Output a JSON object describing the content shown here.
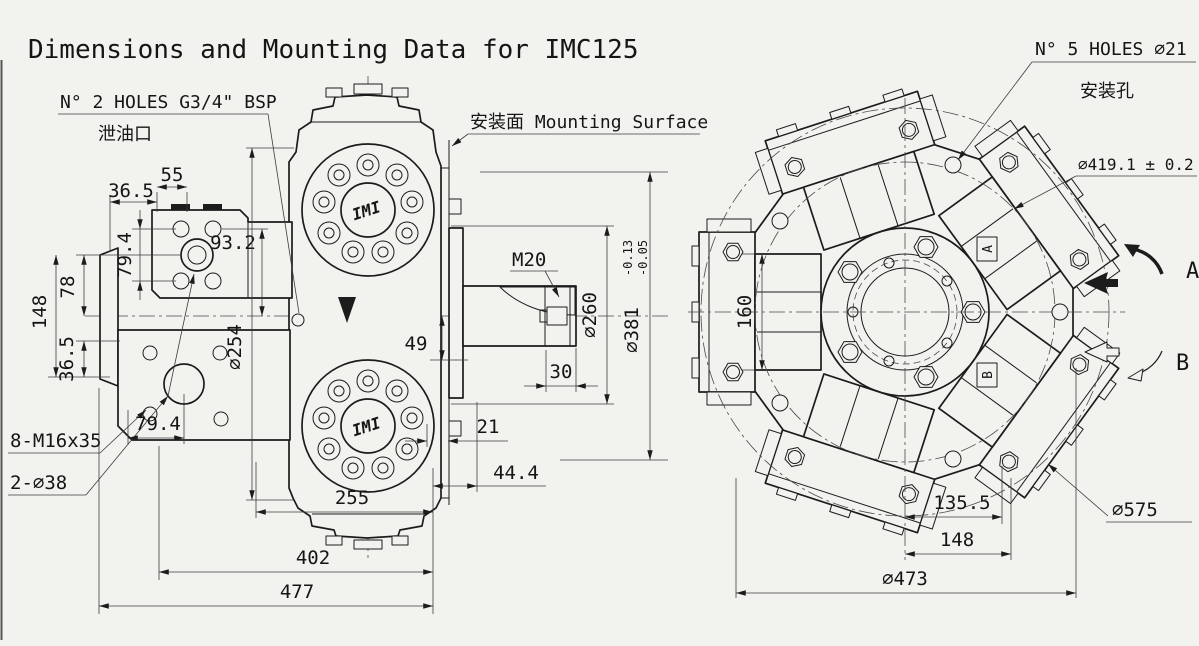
{
  "title": "Dimensions and Mounting Data for IMC125",
  "side_view": {
    "notes": {
      "holes_g34": "N° 2  HOLES G3/4\" BSP",
      "drain_port": "泄油口",
      "mounting_surface": "安装面 Mounting Surface",
      "bolts": "8-M16x35",
      "holes_38": "2-∅38",
      "shaft_thread": "M20",
      "logo": "IMI"
    },
    "dims": {
      "w55": "55",
      "w36_5": "36.5",
      "h79_4": "79.4",
      "w93_2": "93.2",
      "h78": "78",
      "h148": "148",
      "h36_5": "36.5",
      "w79_4": "79.4",
      "d254": "∅254",
      "w255": "255",
      "w402": "402",
      "w477": "477",
      "h49": "49",
      "w21": "21",
      "w44_4": "44.4",
      "w30": "30",
      "d260": "∅260",
      "d381": "∅381",
      "d381_tol_top": "-0.05",
      "d381_tol_bot": "-0.13"
    }
  },
  "front_view": {
    "notes": {
      "holes_21": "N° 5 HOLES ∅21",
      "mounting_holes": "安装孔",
      "d419": "∅419.1 ± 0.2",
      "dir_a": "A",
      "dir_b": "B",
      "port_a": "A",
      "port_b": "B"
    },
    "dims": {
      "h160": "160",
      "w135_5": "135.5",
      "w148": "148",
      "d575": "∅575",
      "d473": "∅473"
    }
  },
  "colors": {
    "background": "#f2f2ef",
    "line": "#1c1c1c"
  }
}
